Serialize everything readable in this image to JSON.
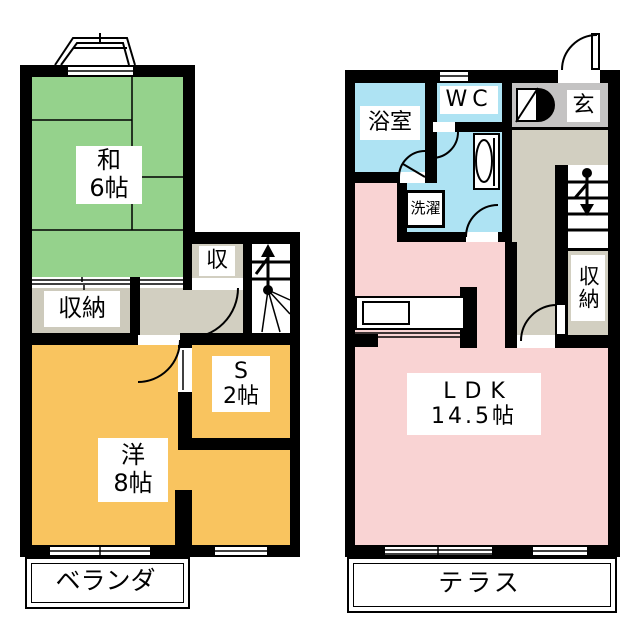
{
  "left_plan": {
    "washitsu": {
      "line1": "和",
      "line2": "6帖"
    },
    "closet": {
      "label": "収"
    },
    "storage": {
      "label": "収納"
    },
    "service_room": {
      "line1": "S",
      "line2": "2帖"
    },
    "western_room": {
      "line1": "洋",
      "line2": "8帖"
    },
    "veranda": {
      "label": "ベランダ"
    }
  },
  "right_plan": {
    "bathroom": {
      "label": "浴室"
    },
    "toilet": {
      "label": "WC"
    },
    "laundry": {
      "label": "洗濯"
    },
    "entrance": {
      "label": "玄"
    },
    "storage": {
      "label": "収納"
    },
    "ldk": {
      "line1": "LDK",
      "line2": "14.5帖"
    },
    "terrace": {
      "label": "テラス"
    }
  },
  "colors": {
    "tatami_green": "#95d28c",
    "wood_orange": "#f9c45f",
    "ldk_pink": "#f9d3d3",
    "water_blue": "#aee3f3",
    "entrance_gray": "#c4c3c3",
    "hall_beige": "#d2cfc1",
    "storage_gray": "#cdcabc",
    "wall_black": "#000000",
    "background": "#ffffff"
  }
}
